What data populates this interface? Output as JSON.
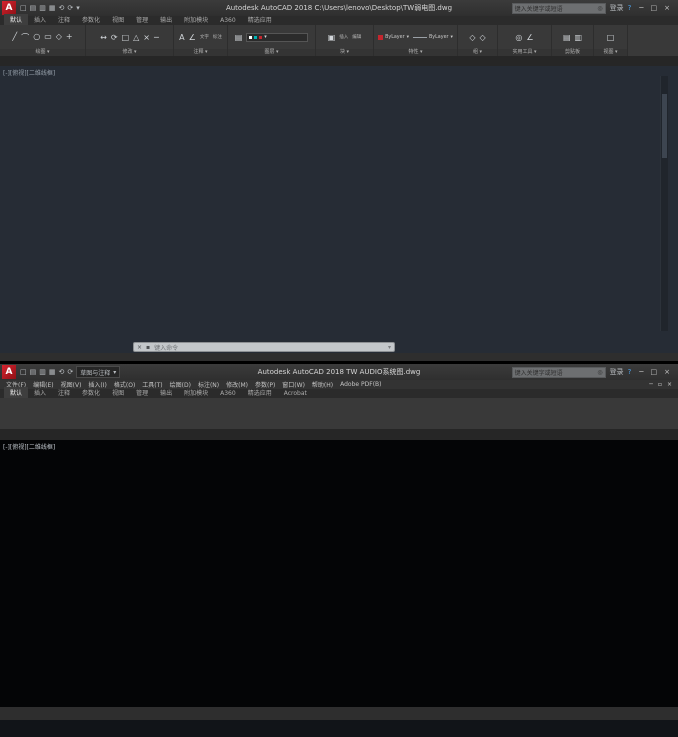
{
  "colors": {
    "accent_red": "#c4262e",
    "wire_green": "#00a000",
    "wire_cyan": "#00b4b4",
    "wire_magenta": "#bb00bb",
    "dash_red": "#7a1f1f",
    "connector_blue": "#1e46d8",
    "plan_red": "#9e1c20",
    "status_blue": "#4da0e8"
  },
  "top_window": {
    "titlebar": {
      "title": "Autodesk AutoCAD 2018   C:\\Users\\lenovo\\Desktop\\TW弱电图.dwg",
      "search_placeholder": "键入关键字或短语",
      "search_icon": "◎",
      "signin": "登录",
      "help_icon": "?",
      "window_buttons": [
        "─",
        "□",
        "×"
      ]
    },
    "qat_icons": [
      {
        "n": "new-file-icon",
        "g": "□"
      },
      {
        "n": "open-file-icon",
        "g": "▤"
      },
      {
        "n": "save-icon",
        "g": "▥"
      },
      {
        "n": "plot-icon",
        "g": "▦"
      },
      {
        "n": "undo-icon",
        "g": "⟲"
      },
      {
        "n": "redo-icon",
        "g": "⟳"
      },
      {
        "n": "qat-dropdown-icon",
        "g": "▾"
      }
    ],
    "ribbon_tabs": [
      {
        "label": "默认",
        "active": true
      },
      {
        "label": "插入"
      },
      {
        "label": "注释"
      },
      {
        "label": "参数化"
      },
      {
        "label": "视图"
      },
      {
        "label": "管理"
      },
      {
        "label": "输出"
      },
      {
        "label": "附加模块"
      },
      {
        "label": "A360"
      },
      {
        "label": "精选应用"
      }
    ],
    "panels": [
      {
        "label": "绘图 ▾",
        "w": 86,
        "icons": [
          "╱",
          "⌒",
          "○",
          "▭",
          "◇",
          "+"
        ]
      },
      {
        "label": "修改 ▾",
        "w": 88,
        "icons": [
          "↔",
          "⟳",
          "□",
          "△",
          "×",
          "─"
        ]
      },
      {
        "label": "注释 ▾",
        "w": 54,
        "icons": [
          "A",
          "∠"
        ],
        "texts": [
          "文字",
          "标注"
        ]
      },
      {
        "label": "图层 ▾",
        "w": 88,
        "icons": [
          "▤"
        ],
        "combo": true
      },
      {
        "label": "块 ▾",
        "w": 58,
        "icons": [
          "▣"
        ],
        "texts": [
          "插入",
          "编辑"
        ]
      },
      {
        "label": "特性 ▾",
        "w": 84,
        "bylayer": [
          "ByLayer",
          "ByLayer"
        ]
      },
      {
        "label": "组 ▾",
        "w": 40,
        "icons": [
          "◇",
          "◇"
        ]
      },
      {
        "label": "实用工具 ▾",
        "w": 54,
        "icons": [
          "◎",
          "∠"
        ]
      },
      {
        "label": "剪贴板",
        "w": 42,
        "icons": [
          "▤",
          "▥"
        ]
      },
      {
        "label": "视图 ▾",
        "w": 34,
        "icons": [
          "□"
        ]
      }
    ],
    "file_tabs": [
      {
        "label": "开始"
      },
      {
        "label": "TW弱电图",
        "active": true,
        "close": "×"
      },
      {
        "label": "+",
        "plus": true
      }
    ],
    "viewport_label": "[-][俯视][二维线框]",
    "doc_window_buttons": [
      "─",
      "▫",
      "×"
    ],
    "command": {
      "close_icon": "×",
      "customize_icon": "▪",
      "prompt": "键入命令",
      "end_icon": "▾"
    },
    "statusbar": {
      "tabs": [
        {
          "label": "模型",
          "active": true
        },
        {
          "label": "布局1"
        },
        {
          "label": "+"
        }
      ],
      "icons": [
        {
          "n": "grid-icon",
          "g": "▦",
          "c": "#4da0e8"
        },
        {
          "n": "snap-icon",
          "g": "⊞",
          "c": "#9aa0a6"
        },
        {
          "n": "ortho-icon",
          "g": "L",
          "c": "#4da0e8"
        },
        {
          "n": "polar-icon",
          "g": "∠",
          "c": "#4da0e8"
        },
        {
          "n": "isodraft-icon",
          "g": "◇",
          "c": "#9aa0a6"
        },
        {
          "n": "osnap-icon",
          "g": "□",
          "c": "#4da0e8"
        },
        {
          "n": "lineweight-icon",
          "g": "≡",
          "c": "#9aa0a6"
        },
        {
          "n": "transparency-icon",
          "g": "▱",
          "c": "#9aa0a6"
        },
        {
          "n": "selection-icon",
          "g": "+",
          "c": "#4da0e8"
        },
        {
          "n": "annotation-icon",
          "g": "A",
          "c": "#4da0e8"
        },
        {
          "n": "workspace-icon",
          "g": "⚙",
          "c": "#9aa0a6"
        },
        {
          "n": "annotation-scale-icon",
          "g": "▾",
          "c": "#9aa0a6"
        },
        {
          "n": "isolate-icon",
          "g": "●",
          "c": "#d79b3c"
        },
        {
          "n": "clean-screen-icon",
          "g": "▣",
          "c": "#4da0e8"
        },
        {
          "n": "customization-icon",
          "g": "≡",
          "c": "#9aa0a6"
        }
      ]
    }
  },
  "bottom_window": {
    "titlebar": {
      "workspace": "草图与注释",
      "workspace_arrow": "▾",
      "title": "Autodesk AutoCAD 2018   TW AUDIO系统图.dwg",
      "search_placeholder": "键入关键字或短语",
      "search_icon": "◎",
      "signin": "登录",
      "help_icon": "?",
      "window_buttons": [
        "─",
        "□",
        "×"
      ]
    },
    "qat_icons": [
      {
        "n": "new-file-icon",
        "g": "□"
      },
      {
        "n": "open-file-icon",
        "g": "▤"
      },
      {
        "n": "save-icon",
        "g": "▥"
      },
      {
        "n": "plot-icon",
        "g": "▦"
      },
      {
        "n": "undo-icon",
        "g": "⟲"
      },
      {
        "n": "redo-icon",
        "g": "⟳"
      }
    ],
    "menus": [
      "文件(F)",
      "编辑(E)",
      "视图(V)",
      "插入(I)",
      "格式(O)",
      "工具(T)",
      "绘图(D)",
      "标注(N)",
      "修改(M)",
      "参数(P)",
      "窗口(W)",
      "帮助(H)",
      "Adobe PDF(B)"
    ],
    "doc_window_buttons": [
      "─",
      "▫",
      "×"
    ],
    "ribbon_tabs": [
      {
        "label": "默认",
        "active": true
      },
      {
        "label": "插入"
      },
      {
        "label": "注释"
      },
      {
        "label": "参数化"
      },
      {
        "label": "视图"
      },
      {
        "label": "管理"
      },
      {
        "label": "输出"
      },
      {
        "label": "附加模块"
      },
      {
        "label": "A360"
      },
      {
        "label": "精选应用"
      },
      {
        "label": "Acrobat"
      }
    ],
    "file_tabs": [
      {
        "label": "开始"
      },
      {
        "label": "TW AUDIO系统图",
        "active": true,
        "close": "×"
      },
      {
        "label": "+",
        "plus": true
      }
    ],
    "viewport_label": "[-][俯视][二维线框]",
    "drawing": {
      "left_labels": [
        "音箱布线、视频机柜",
        "控制室控制系统"
      ],
      "right_labels": [
        "内场音响设备机房",
        "扩声音箱"
      ],
      "viewcube": {
        "n": "北",
        "s": "南",
        "w": "西",
        "e": "东",
        "top": "上"
      },
      "ucs_x": "X",
      "ucs_w": "W",
      "legend": {
        "title": "图例说明:",
        "rows": [
          {
            "color": "#00a000",
            "dash": false,
            "name": "音频信号线",
            "c2": "4芯",
            "c3": "六类网线",
            "c4": "RJ45",
            "c5": "扩声系统信号通路(1对/只)"
          },
          {
            "color": "#00b4b4",
            "dash": false,
            "name": "网络信号线",
            "c2": "8芯",
            "c3": "千兆光纤",
            "c4": "Dante",
            "c5": "数字音频传输通路(1:1)"
          },
          {
            "color": "#bb00bb",
            "dash": false,
            "name": "控制信号线",
            "c2": "2芯",
            "c3": "RS232",
            "c4": "Crestron",
            "c5": "设备集中控制通路"
          },
          {
            "color": "#aa2222",
            "dash": true,
            "name": "电源线",
            "c2": "3芯",
            "c3": "RVV2.5",
            "c4": "配电箱",
            "c5": "交流220V供电(1处-1路)"
          },
          {
            "color": "#00a000",
            "dash": false,
            "name": "光纤链路",
            "c2": "双芯",
            "c3": "RS232",
            "c4": "KVM",
            "c5": "Dante Signal(+)/备份(-)"
          }
        ]
      }
    },
    "statusbar": {
      "model_label": "模型",
      "tabs": [
        {
          "label": "模型",
          "active": true
        },
        {
          "label": "布局1"
        },
        {
          "label": "布局2"
        },
        {
          "label": "+"
        }
      ],
      "icons": [
        {
          "n": "grid-icon",
          "g": "▦",
          "c": "#4da0e8"
        },
        {
          "n": "snap-icon",
          "g": "⊞",
          "c": "#9aa0a6"
        },
        {
          "n": "ortho-icon",
          "g": "L",
          "c": "#4da0e8"
        },
        {
          "n": "polar-icon",
          "g": "∠",
          "c": "#9aa0a6"
        },
        {
          "n": "isodraft-icon",
          "g": "◇",
          "c": "#9aa0a6"
        },
        {
          "n": "osnap-icon",
          "g": "□",
          "c": "#4da0e8"
        },
        {
          "n": "object-snap-icon",
          "g": "⊡",
          "c": "#4da0e8"
        },
        {
          "n": "lineweight-icon",
          "g": "≡",
          "c": "#9aa0a6"
        },
        {
          "n": "selection-cycling-icon",
          "g": "+",
          "c": "#9aa0a6"
        },
        {
          "n": "annotation-icon",
          "g": "A",
          "c": "#4da0e8"
        },
        {
          "n": "annotation-vis-icon",
          "g": "A",
          "c": "#9aa0a6"
        },
        {
          "n": "scale-icon",
          "g": "▾",
          "c": "#9aa0a6"
        },
        {
          "n": "workspace-gear-icon",
          "g": "⚙",
          "c": "#9aa0a6"
        },
        {
          "n": "isolate-icon",
          "g": "●",
          "c": "#d79b3c"
        },
        {
          "n": "hardware-icon",
          "g": "▣",
          "c": "#4da0e8",
          "bg": "#2f6fb0"
        },
        {
          "n": "clean-screen-icon",
          "g": "▢",
          "c": "#cfd3d7",
          "bg": "#2f6fb0"
        },
        {
          "n": "customization-icon",
          "g": "≡",
          "c": "#9aa0a6"
        }
      ]
    }
  }
}
